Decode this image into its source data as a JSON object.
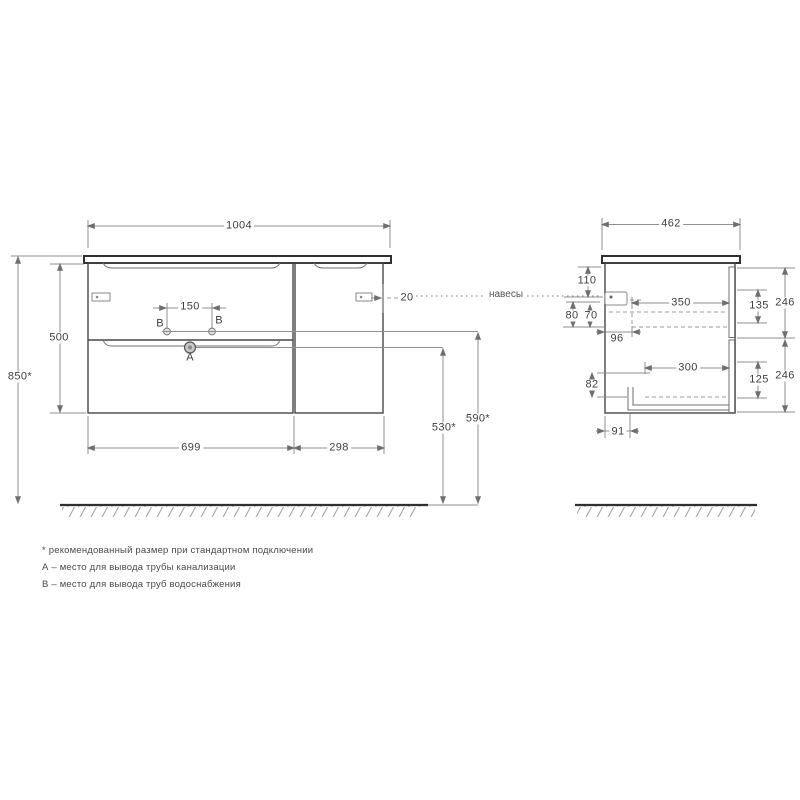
{
  "drawing": {
    "callout_hangers": "навесы",
    "front_view": {
      "width_top": "1004",
      "cabinet_height": "500",
      "total_height": "850*",
      "marker_b_left": "B",
      "marker_b_right": "B",
      "marker_a": "A",
      "faucet_hole_spacing": "150",
      "hanger_edge_offset": "20",
      "bottom_width_left": "699",
      "bottom_width_right": "298",
      "drain_outlet_height": "530*",
      "water_outlet_height": "590*"
    },
    "side_view": {
      "depth_top": "462",
      "top_to_hanger": "110",
      "hanger_offset_outer": "80",
      "hanger_offset_inner": "70",
      "hanger_inset_depth": "96",
      "upper_clearance_depth": "350",
      "upper_inner_height": "135",
      "upper_front_height": "246",
      "lower_clearance_depth": "300",
      "lower_inner_height": "125",
      "lower_front_height": "246",
      "bottom_inner_height": "82",
      "siphon_inset_depth": "91"
    },
    "notes": {
      "line1": "* рекомендованный размер при стандартном подключении",
      "line2": "А – место для вывода трубы канализации",
      "line3": "В – место для вывода труб водоснабжения"
    },
    "colors": {
      "outline": "#474747",
      "dimension": "#8f8f8f",
      "text": "#3f3f3f"
    }
  }
}
